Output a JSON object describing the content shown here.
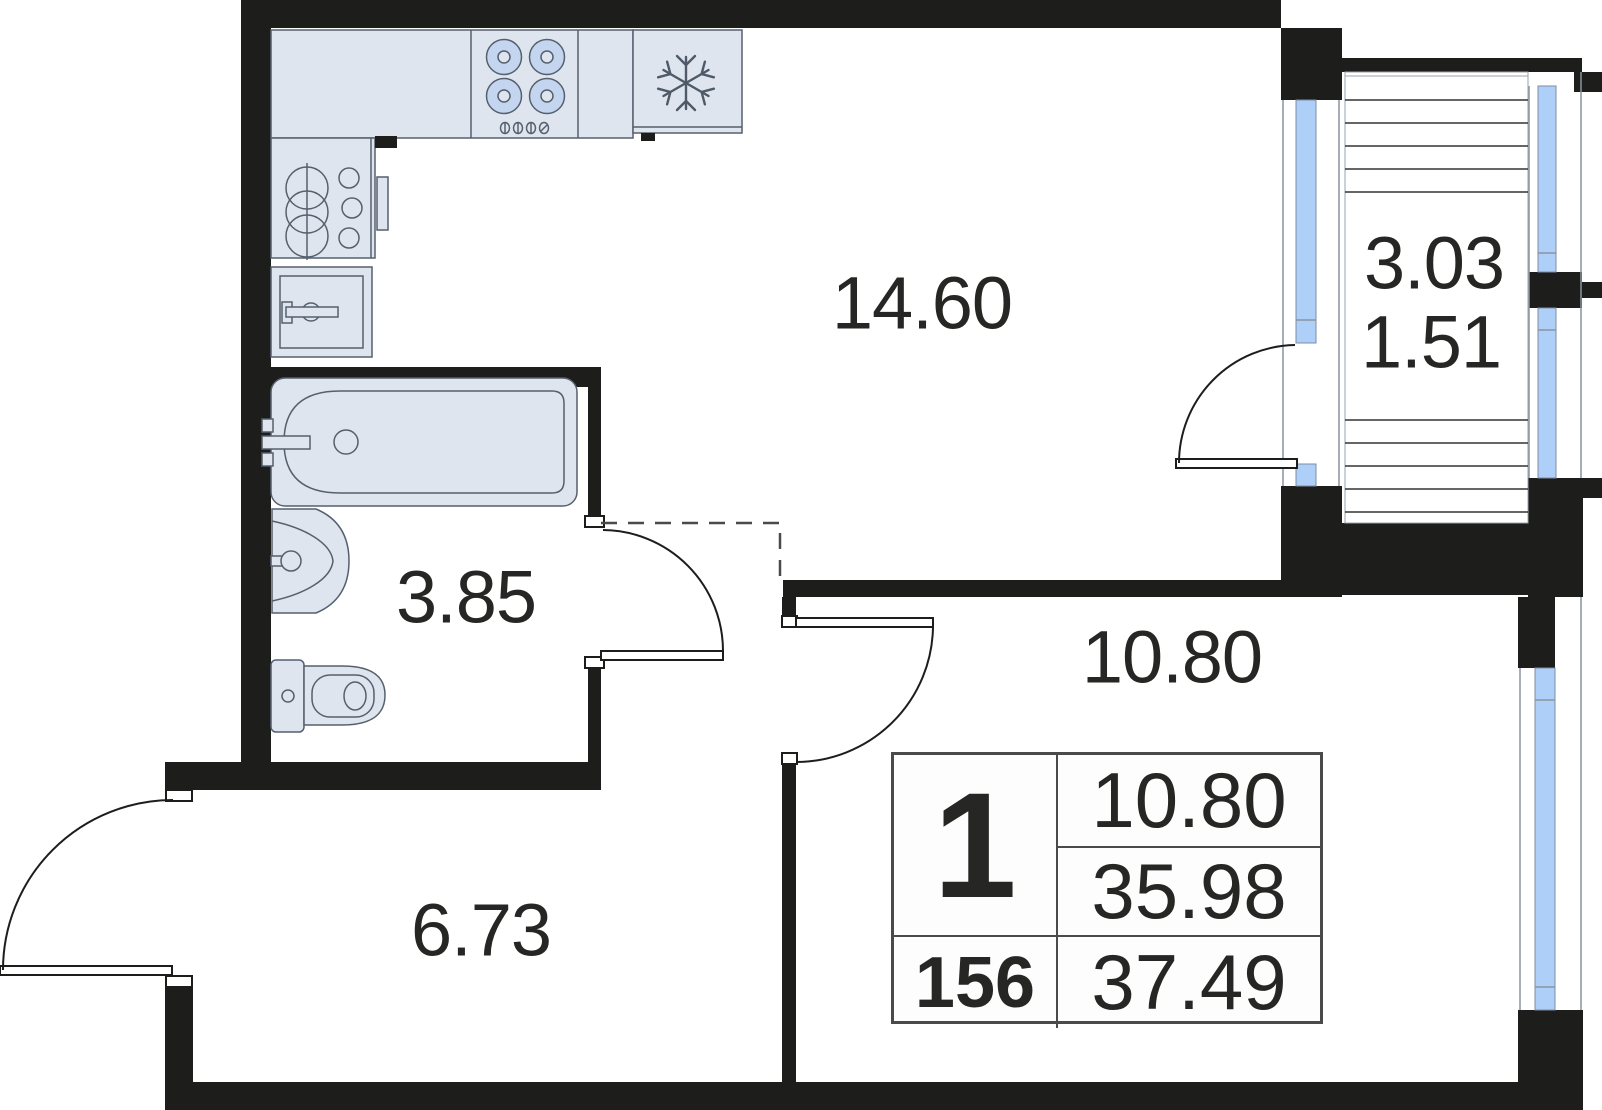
{
  "floor_plan": {
    "room_labels": {
      "living_kitchen": "14.60",
      "balcony_area_full": "3.03",
      "balcony_area_reduced": "1.51",
      "bathroom": "3.85",
      "hallway": "6.73",
      "bedroom": "10.80"
    },
    "info_table": {
      "room_count": "1",
      "bedroom_area": "10.80",
      "area_without_balcony": "35.98",
      "unit_number": "156",
      "total_area": "37.49"
    },
    "icons": {
      "fridge": "snowflake-icon"
    },
    "colors": {
      "wall": "#1d1d1b",
      "fixture_fill": "#dfe5ee",
      "fixture_stroke": "#55606e",
      "window_glass": "#aecff8",
      "burner_fill": "#c3d5ef",
      "hatch_line": "#333333",
      "dashed_line": "#4a4a4a",
      "text": "#262624",
      "table_border": "#4a4a4a",
      "background": "#ffffff"
    }
  }
}
